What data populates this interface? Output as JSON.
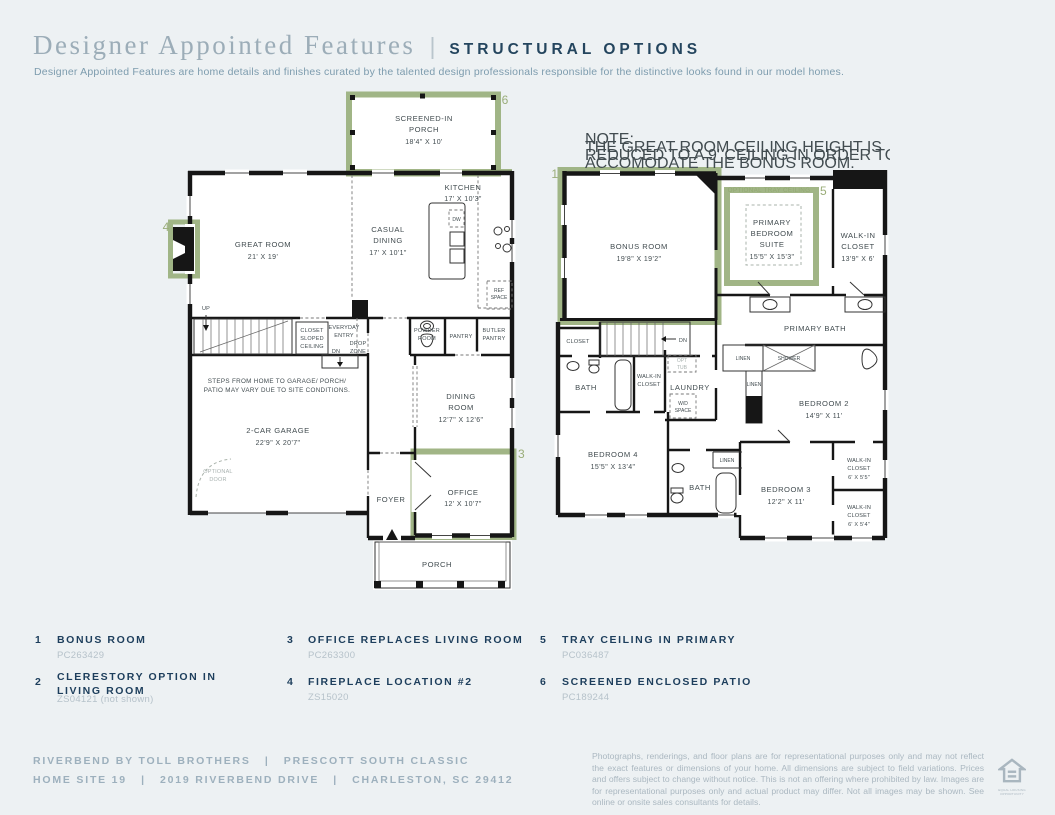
{
  "header": {
    "title_serif": "Designer Appointed Features",
    "divider": "|",
    "title_sans": "STRUCTURAL OPTIONS",
    "subtitle": "Designer Appointed Features are home details and finishes curated by the talented design professionals responsible for the distinctive looks found in our model homes."
  },
  "colors": {
    "accent_green": "#9cb180",
    "navy": "#1d3e5c",
    "page_bg": "#edf1f3"
  },
  "floor1": {
    "marker3": "3",
    "marker4": "4",
    "marker6": "6",
    "screened_porch": [
      "SCREENED-IN",
      "PORCH",
      "18'4\" X 10'"
    ],
    "kitchen": [
      "KITCHEN",
      "17' X 10'3\""
    ],
    "casual_dining": [
      "CASUAL",
      "DINING",
      "17' X 10'1\""
    ],
    "great_room": [
      "GREAT ROOM",
      "21' X 19'"
    ],
    "dining_room": [
      "DINING",
      "ROOM",
      "12'7\" X 12'6\""
    ],
    "office": [
      "OFFICE",
      "12' X 10'7\""
    ],
    "garage": [
      "2-CAR GARAGE",
      "22'9\" X 20'7\""
    ],
    "foyer": "FOYER",
    "porch": "PORCH",
    "powder": [
      "POWDER",
      "ROOM"
    ],
    "pantry": "PANTRY",
    "butler": [
      "BUTLER",
      "PANTRY"
    ],
    "closet_sloped": [
      "CLOSET",
      "SLOPED",
      "CEILING"
    ],
    "everyday": [
      "EVERYDAY",
      "ENTRY"
    ],
    "drop": [
      "DROP",
      "ZONE"
    ],
    "dn": "DN",
    "up": "UP",
    "ref": [
      "REF",
      "SPACE"
    ],
    "dw": "DW",
    "steps_note": [
      "STEPS FROM HOME TO GARAGE/ PORCH/",
      "PATIO MAY VARY DUE TO SITE CONDITIONS."
    ],
    "optional_door": [
      "OPTIONAL",
      "DOOR"
    ]
  },
  "floor2": {
    "marker1": "1",
    "marker5": "5",
    "note": [
      "NOTE:",
      "THE GREAT ROOM CEILING HEIGHT IS",
      "REDUCED TO A 9' CEILING IN ORDER TO",
      "ACCOMODATE THE BONUS ROOM."
    ],
    "bonus": [
      "BONUS ROOM",
      "19'8\" X 19'2\""
    ],
    "tray": "OPTIONAL TRAY CEILING",
    "primary_suite": [
      "PRIMARY",
      "BEDROOM",
      "SUITE",
      "15'5\" X 15'3\""
    ],
    "wic_primary": [
      "WALK-IN",
      "CLOSET",
      "13'9\" X 6'"
    ],
    "primary_bath": "PRIMARY BATH",
    "shower": "SHOWER",
    "linen1": "LINEN",
    "linen2": "LINEN",
    "linen3": "LINEN",
    "bedroom2": [
      "BEDROOM 2",
      "14'9\" X 11'"
    ],
    "bedroom3": [
      "BEDROOM 3",
      "12'2\" X 11'"
    ],
    "bedroom4": [
      "BEDROOM 4",
      "15'5\" X 13'4\""
    ],
    "closet": "CLOSET",
    "bath_mid": "BATH",
    "bath_low": "BATH",
    "wic_mid": [
      "WALK-IN",
      "CLOSET"
    ],
    "opt_tub": [
      "OPT",
      "TUB"
    ],
    "laundry": "LAUNDRY",
    "wd": [
      "W/D",
      "SPACE"
    ],
    "dn": "DN",
    "wic_a": [
      "WALK-IN",
      "CLOSET",
      "6' X 5'5\""
    ],
    "wic_b": [
      "WALK-IN",
      "CLOSET",
      "6' X 5'4\""
    ]
  },
  "options": [
    {
      "num": "1",
      "label": "BONUS ROOM",
      "code": "PC263429"
    },
    {
      "num": "2",
      "label": "CLERESTORY OPTION IN LIVING ROOM",
      "code": "ZS04121 (not shown)"
    },
    {
      "num": "3",
      "label": "OFFICE REPLACES LIVING ROOM",
      "code": "PC263300"
    },
    {
      "num": "4",
      "label": "FIREPLACE LOCATION #2",
      "code": "ZS15020"
    },
    {
      "num": "5",
      "label": "TRAY CEILING IN PRIMARY",
      "code": "PC036487"
    },
    {
      "num": "6",
      "label": "SCREENED ENCLOSED PATIO",
      "code": "PC189244"
    }
  ],
  "footer": {
    "line1": "RIVERBEND BY TOLL BROTHERS   |   PRESCOTT SOUTH CLASSIC",
    "line2": "HOME SITE 19   |   2019 RIVERBEND DRIVE   |   CHARLESTON, SC 29412",
    "disclaimer": "Photographs, renderings, and floor plans are for representational purposes only and may not reflect the exact features or dimensions of your home. All dimensions are subject to field variations. Prices and offers subject to change without notice. This is not an offering where prohibited by law. Images are for representational purposes only and actual product may differ. Not all images may be shown. See online or onsite sales consultants for details.",
    "equal_housing": "EQUAL HOUSING OPPORTUNITY"
  }
}
